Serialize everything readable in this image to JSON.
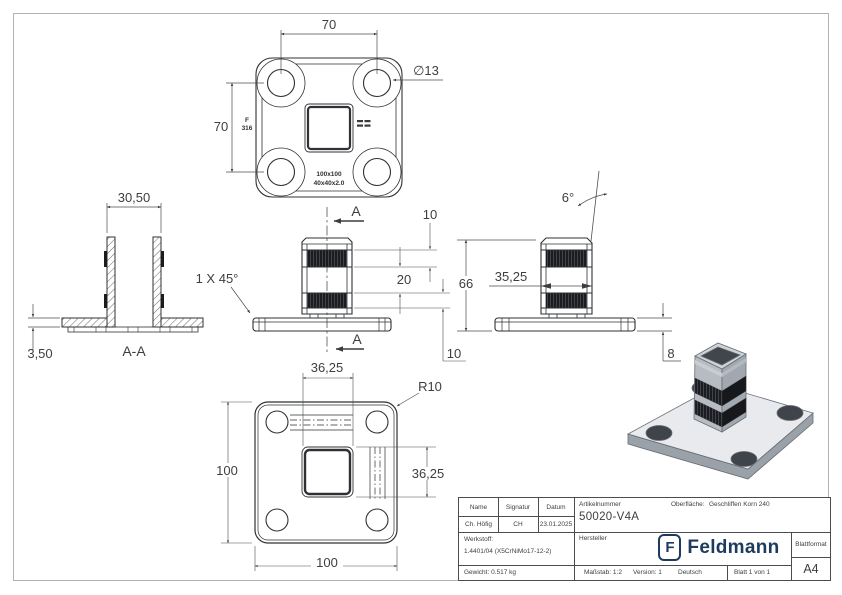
{
  "drawing": {
    "top_view": {
      "dim_hole_spacing_h": "70",
      "dim_hole_spacing_v": "70",
      "dim_hole_dia": "∅13",
      "stamp_grade_line1": "F",
      "stamp_grade_line2": "316",
      "stamp_size_line1": "100x100",
      "stamp_size_line2": "40x40x2.0",
      "section_arrow_top": "A",
      "section_arrow_bottom": "A"
    },
    "section_view": {
      "title": "A-A",
      "dim_tube_width": "30,50",
      "dim_sheet_thickness": "3,50",
      "chamfer_note": "1 X 45°"
    },
    "front_view": {
      "dim_band_top": "10",
      "dim_band_gap": "20",
      "dim_band_bottom": "10"
    },
    "side_view": {
      "dim_height": "66",
      "dim_tube_width": "35,25",
      "dim_taper_angle": "6°",
      "dim_base_height": "8"
    },
    "bottom_view": {
      "dim_offset_h": "36,25",
      "dim_offset_v": "36,25",
      "dim_plate_width": "100",
      "dim_plate_height": "100",
      "corner_radius": "R10"
    }
  },
  "title_block": {
    "col_name": "Name",
    "col_signature": "Signatur",
    "col_date": "Datum",
    "name": "Ch. Höfig",
    "signature": "CH",
    "date": "23.01.2025",
    "article_label": "Artikelnummer",
    "article_number": "50020-V4A",
    "surface_label": "Oberfläche:",
    "surface_value": "Geschliffen Korn 240",
    "material_label": "Werkstoff:",
    "material_value": "1.4401/04 (X5CrNiMo17-12-2)",
    "manufacturer_label": "Hersteller",
    "brand_initial": "F",
    "brand_name": "Feldmann",
    "format_label": "Blattformat",
    "format_value": "A4",
    "weight": "Gewicht: 0.517 kg",
    "scale": "Maßstab: 1:2",
    "version": "Version: 1",
    "language": "Deutsch",
    "sheet": "Blatt 1 von 1"
  },
  "colors": {
    "brand_blue": "#1c3b5f",
    "line": "#2f3134",
    "dimension": "#4a4d51"
  }
}
